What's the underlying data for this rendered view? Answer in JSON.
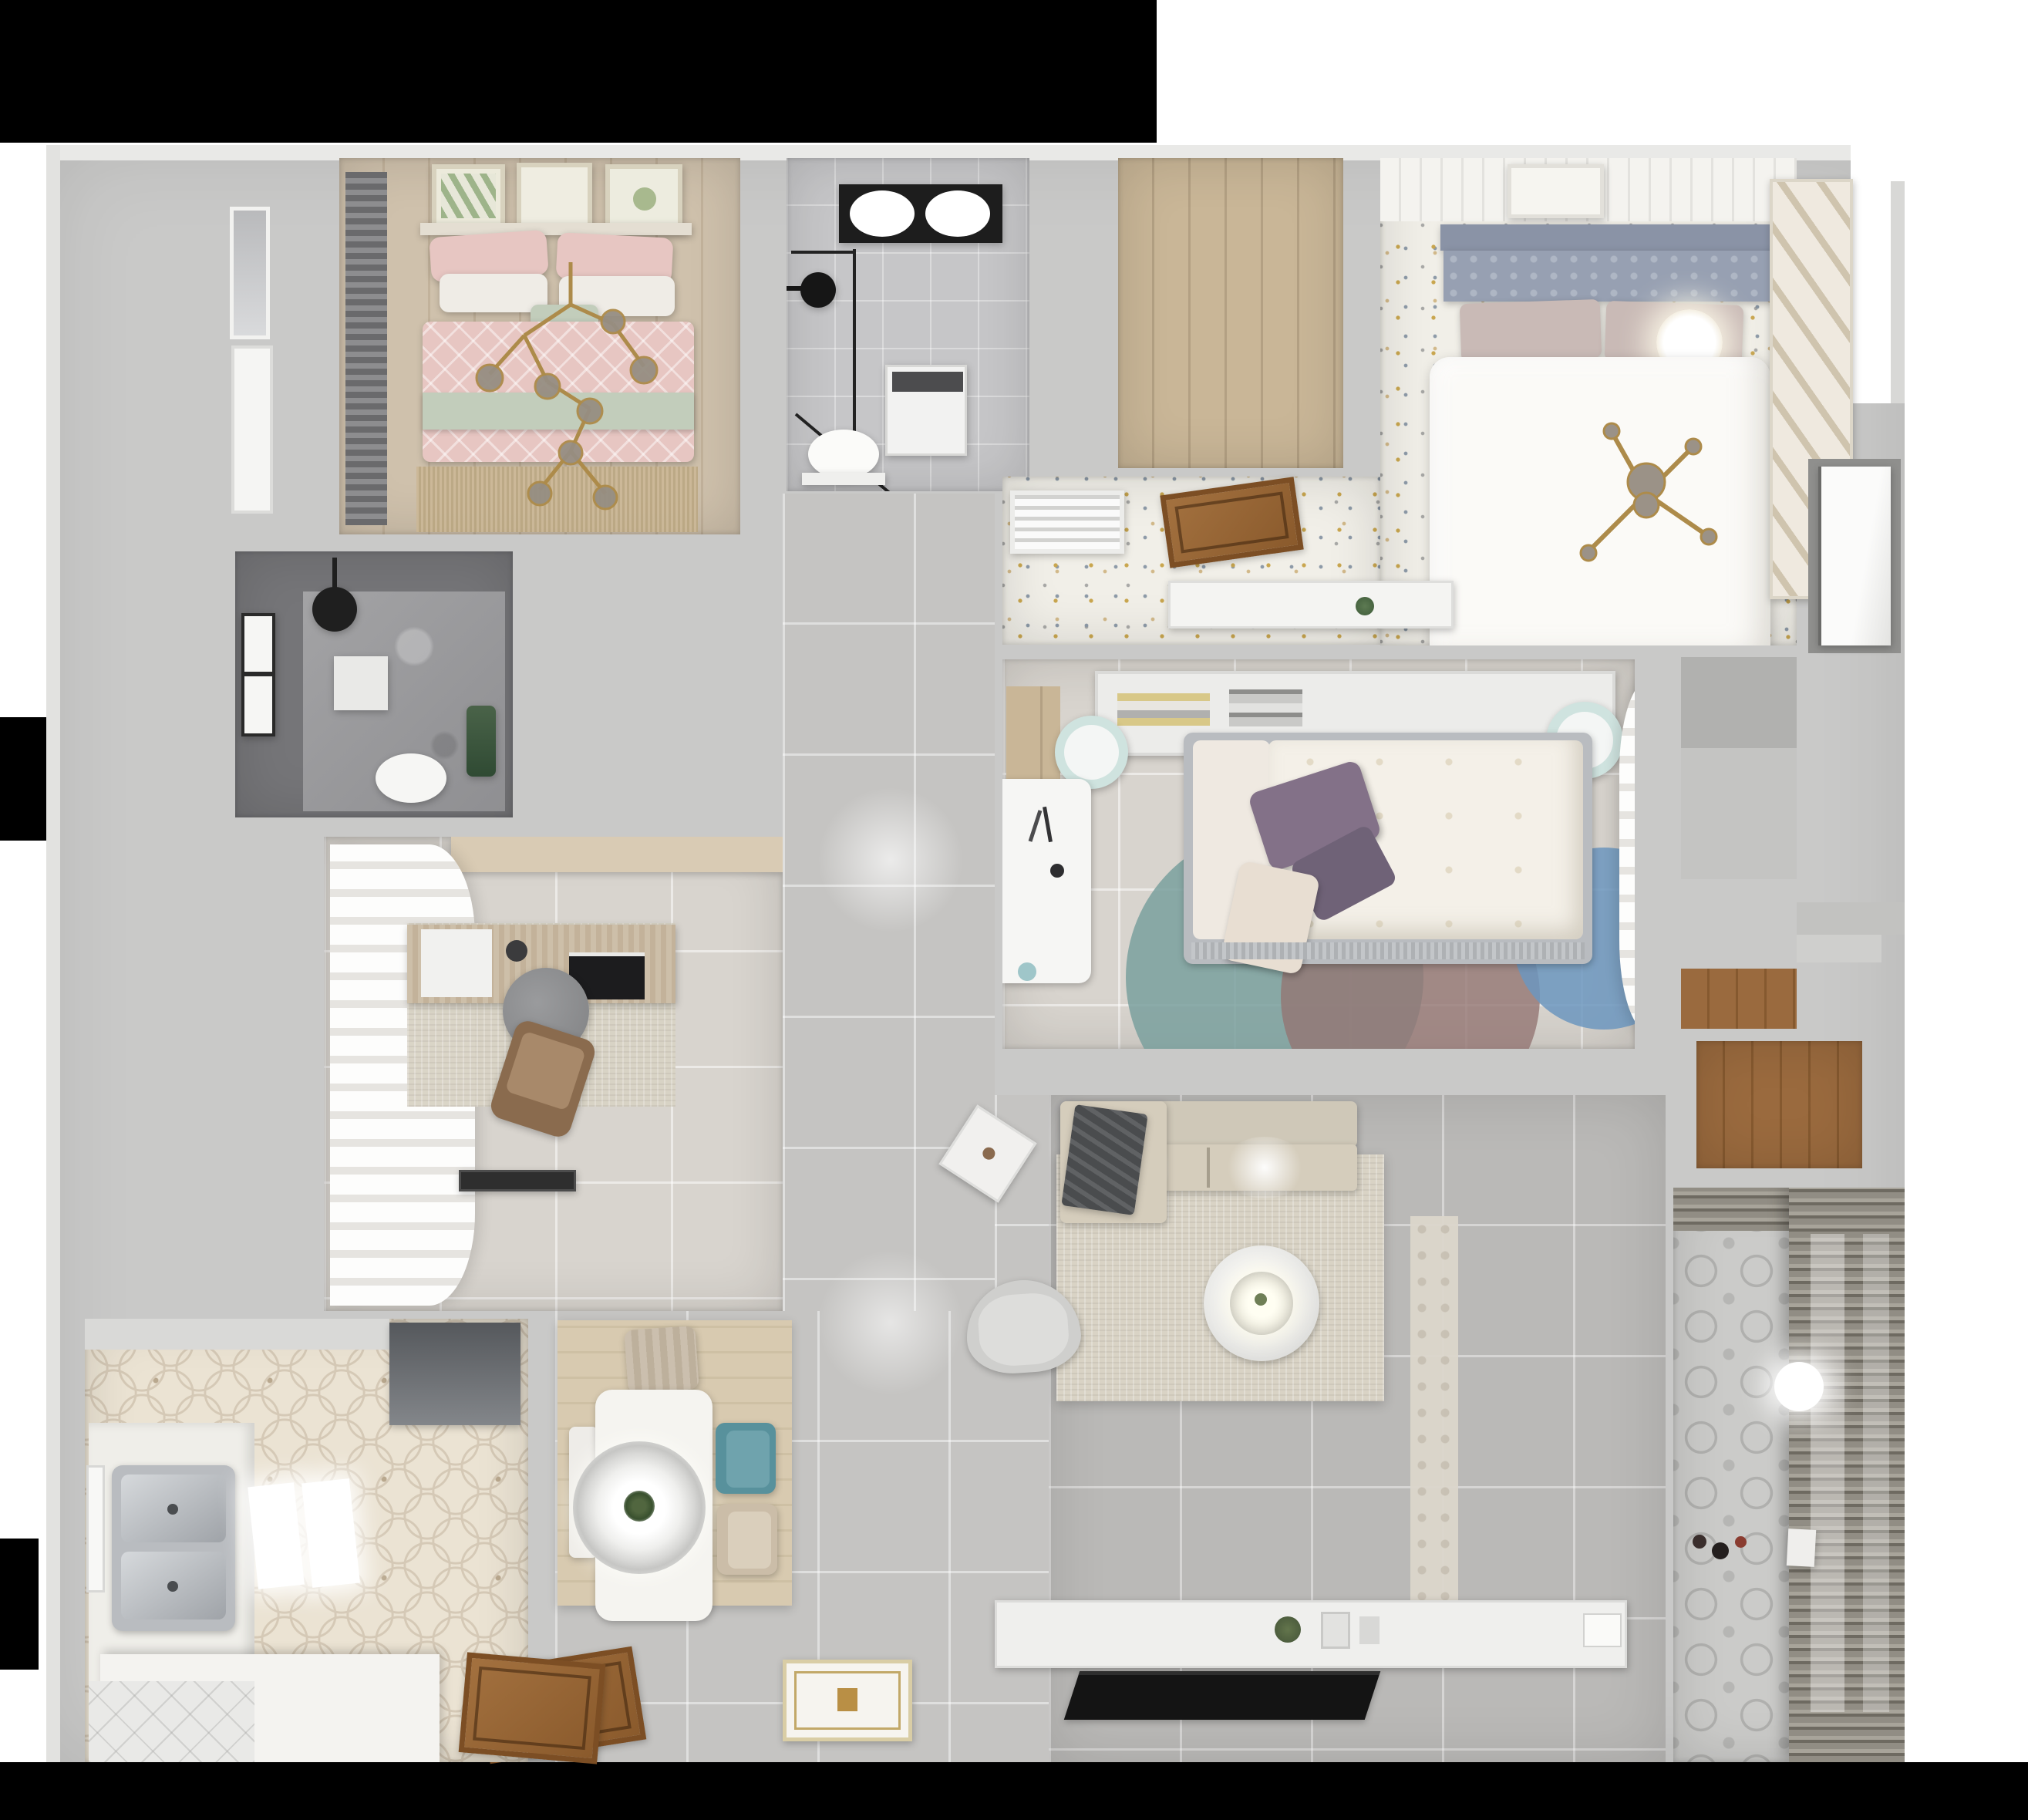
{
  "scene": {
    "type": "3d-floor-plan-top-down-render",
    "description": "Photorealistic top-down 3D render of a fully furnished apartment; no visible text anywhere in the image",
    "rooms_count": 13
  },
  "colors": {
    "bg": "#ffffff",
    "black": "#000000",
    "wall": "#c9c9c8",
    "wallFace": "#e9e9e7",
    "wood": "#cfc1ac",
    "woodDark": "#c2b29b",
    "tileBath": "#c6c6c8",
    "tileLight": "#d8d4ce",
    "tileGray": "#c5c4c2",
    "tileLiving": "#bab9b7",
    "speckleBase": "#f1efe8",
    "hexBase": "#ebe3d3",
    "balconyBase": "#cbcbc9",
    "pink": "#e7c6c2",
    "sage": "#c2cdbb",
    "teal": "#58919c",
    "mint": "#cfe3df",
    "purple": "#837188",
    "mauve": "#c9bab6",
    "slate": "#97a0b2",
    "gold": "#ad8b4a",
    "doorWood": "#98663a",
    "rugBeige": "#d9d3c5",
    "duvetWhite": "#fbfaf7",
    "bathDark": "#757578",
    "sofa": "#d5cdbc",
    "throw": "#4a4c4e",
    "tv": "#141414"
  },
  "rooms": [
    {
      "id": "bedroom-pink",
      "label": "bedroom with pink bedding (top-left)",
      "floor": "light wood planks",
      "furniture": [
        "double bed",
        "pink patterned duvet",
        "sage throw",
        "pink and white pillows",
        "gold branch chandelier with glass globes",
        "three botanical wall-art frames",
        "dark roman blind",
        "fringed rug",
        "left wall window"
      ]
    },
    {
      "id": "bathroom-skylight",
      "label": "bathroom with skylight (top-center)",
      "floor": "gray tile",
      "furniture": [
        "black framed skylight",
        "corner glass shower",
        "black shower head",
        "washing machine",
        "toilet"
      ]
    },
    {
      "id": "walk-in-closet",
      "label": "empty walk-in closet (top-middle)",
      "floor": "wood planks",
      "furniture": []
    },
    {
      "id": "bedroom-white",
      "label": "bedroom with white bed (top-right)",
      "floor": "colorful terrazzo speckle",
      "furniture": [
        "slate tufted headboard",
        "mauve pillows",
        "white duvet",
        "glowing sphere lamp",
        "gold cross chandelier",
        "plank ceiling strip with art frame",
        "diagonal-slat wardrobe"
      ]
    },
    {
      "id": "speckle-corridor",
      "label": "corridor nook by white bedroom",
      "floor": "terrazzo speckle",
      "furniture": [
        "AC vent grille",
        "open wooden door",
        "white console shelf with plant"
      ]
    },
    {
      "id": "shower-room",
      "label": "dark tiled shower room (mid-left)",
      "floor": "marble tile",
      "furniture": [
        "window",
        "black rain shower head",
        "white shelf",
        "toilet",
        "green plant"
      ]
    },
    {
      "id": "study",
      "label": "study / home office (left)",
      "floor": "large beige tiles",
      "furniture": [
        "white wavy curtains",
        "wood desk",
        "monitor",
        "white blotter",
        "round gray chair",
        "brown lounge chair",
        "textured rug",
        "dark doormat",
        "tan cabinet strip"
      ]
    },
    {
      "id": "bedroom-center",
      "label": "center bedroom",
      "floor": "large light tiles",
      "furniture": [
        "white headboard shelf with books",
        "gray framed bed",
        "floral cream duvet",
        "purple pillows",
        "two mint poufs",
        "white desk with teal cup",
        "overlapping circle rug (teal, mauve, blue)",
        "sheer curtains",
        "wood floor nook"
      ]
    },
    {
      "id": "hallway",
      "label": "hallway and entry",
      "floor": "large gray tiles",
      "furniture": [
        "ornate entry mat",
        "open wooden entry door",
        "recessed light glow"
      ]
    },
    {
      "id": "living-room",
      "label": "living room",
      "floor": "gray tiles",
      "furniture": [
        "beige sectional sofa",
        "dark gray throw",
        "round white coffee table with lamp glow",
        "beige area rug",
        "white side table",
        "rounded armchair",
        "white TV console with plant",
        "flat TV leaning",
        "patterned runner"
      ]
    },
    {
      "id": "kitchen",
      "label": "kitchen (bottom-left)",
      "floor": "hexagon patterned tile",
      "furniture": [
        "dark range hood",
        "white counters",
        "double stainless sink",
        "two glowing ceiling lights",
        "white island counter",
        "white diagonal tile corner",
        "open wooden door",
        "window"
      ]
    },
    {
      "id": "dining",
      "label": "dining nook",
      "floor": "wood-look rug over gray tile",
      "furniture": [
        "white rectangular table",
        "concentric ring pendant lamp with plant",
        "striped tan chair",
        "teal chair",
        "beige chair",
        "white bench"
      ]
    },
    {
      "id": "balcony",
      "label": "balcony / laundry (bottom-right)",
      "floor": "patterned cement tile",
      "furniture": [
        "slatted blinds wall",
        "round white ceiling lamp",
        "small toys",
        "white storage box"
      ]
    },
    {
      "id": "service-annex",
      "label": "right service annex",
      "floor": "concrete gray",
      "furniture": [
        "white door in niche",
        "shaft blocks",
        "dark wood storage floor",
        "steps"
      ]
    }
  ]
}
